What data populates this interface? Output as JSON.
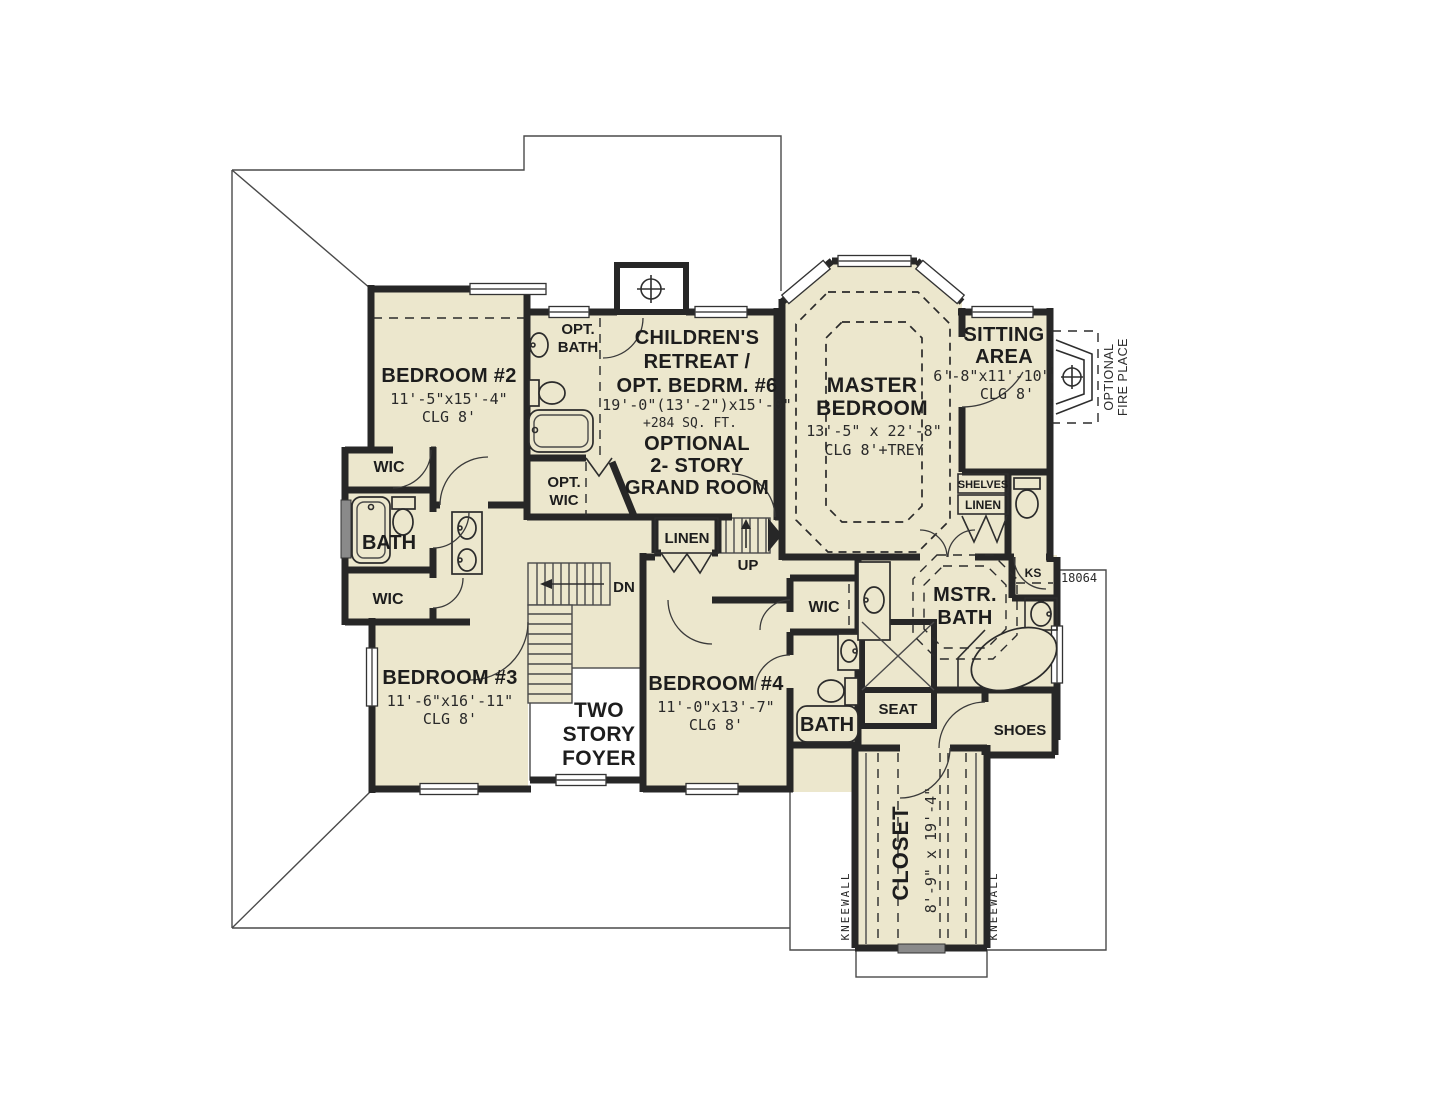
{
  "plan": {
    "number": "18064",
    "bedroom2": {
      "name": "BEDROOM #2",
      "dims": "11'-5\"x15'-4\"",
      "clg": "CLG 8'"
    },
    "bedroom3": {
      "name": "BEDROOM #3",
      "dims": "11'-6\"x16'-11\"",
      "clg": "CLG 8'"
    },
    "bedroom4": {
      "name": "BEDROOM #4",
      "dims": "11'-0\"x13'-7\"",
      "clg": "CLG 8'"
    },
    "master_bedroom": {
      "name1": "MASTER",
      "name2": "BEDROOM",
      "dims": "13'-5\" x 22'-8\"",
      "clg": "CLG 8'+TREY"
    },
    "childrens_retreat": {
      "name1": "CHILDREN'S",
      "name2": "RETREAT /",
      "name3": "OPT. BEDRM. #6",
      "dims": "19'-0\"(13'-2\")x15'-0\"",
      "sqft": "+284 SQ. FT."
    },
    "grand_room": {
      "name1": "OPTIONAL",
      "name2": "2- STORY",
      "name3": "GRAND ROOM"
    },
    "sitting_area": {
      "name1": "SITTING",
      "name2": "AREA",
      "dims": "6'-8\"x11'-10\"",
      "clg": "CLG 8'"
    },
    "foyer": {
      "name1": "TWO",
      "name2": "STORY",
      "name3": "FOYER"
    },
    "master_bath": {
      "name1": "MSTR.",
      "name2": "BATH"
    },
    "master_closet": {
      "name": "CLOSET",
      "dims": "8'-9\" x 19'-4\""
    },
    "opt_bath": {
      "name1": "OPT.",
      "name2": "BATH"
    },
    "opt_wic": {
      "name1": "OPT.",
      "name2": "WIC"
    },
    "labels": {
      "wic": "WIC",
      "bath": "BATH",
      "seat": "SEAT",
      "shoes": "SHOES",
      "ks": "KS",
      "shelves": "SHELVES",
      "linen": "LINEN",
      "dn": "DN",
      "up": "UP",
      "kneewall": "KNEEWALL",
      "fireplace1": "OPTIONAL",
      "fireplace2": "FIRE PLACE"
    }
  }
}
